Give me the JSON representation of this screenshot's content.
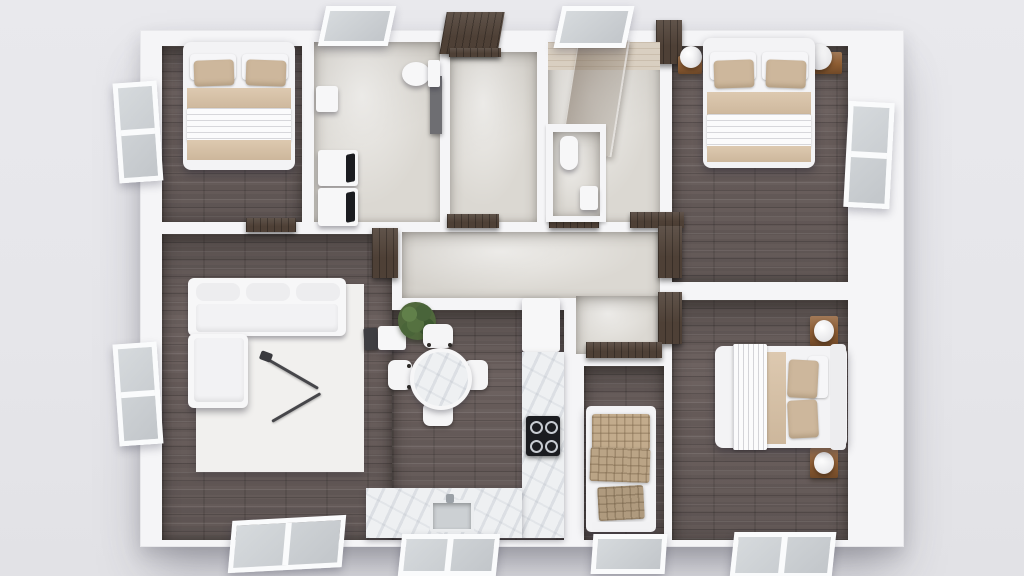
{
  "scene": {
    "description": "Top-down 3D architectural rendering of a three-bedroom apartment floor plan; photorealistic render with no text labels",
    "rooms": [
      {
        "id": "bedroom-1",
        "position": "top-left",
        "flooring": "dark wood planks",
        "furniture": [
          "double bed with white duvet and two beige pillows"
        ]
      },
      {
        "id": "bathroom-laundry",
        "position": "top-center-left",
        "flooring": "light concrete",
        "furniture": [
          "toilet",
          "white wall cabinet",
          "stacked washer and dryer",
          "dark vanity strip"
        ]
      },
      {
        "id": "entry-hall",
        "position": "top-center",
        "flooring": "light concrete",
        "furniture": [
          "open dark-walnut front door"
        ]
      },
      {
        "id": "bathroom-2",
        "position": "top-center-right",
        "flooring": "light concrete with travertine band",
        "furniture": [
          "smoked-glass shower screen",
          "WC niche with toilet",
          "small white cabinet"
        ]
      },
      {
        "id": "bedroom-2",
        "position": "top-right",
        "flooring": "dark wood planks",
        "furniture": [
          "double bed with white duvet and beige pillows",
          "two nightstands",
          "two white sphere lamps"
        ]
      },
      {
        "id": "living-room",
        "position": "center-left",
        "flooring": "dark wood planks",
        "furniture": [
          "white L-shaped sectional sofa",
          "white area rug",
          "black angled floor lamp",
          "white side table",
          "potted plant",
          "small dark speaker"
        ]
      },
      {
        "id": "dining-area",
        "position": "center",
        "flooring": "dark wood planks",
        "furniture": [
          "round marble dining table",
          "four white chairs with dark arm tips"
        ]
      },
      {
        "id": "kitchen",
        "position": "center-right",
        "flooring": "dark wood planks",
        "furniture": [
          "L-shaped marble counter",
          "black four-burner cooktop",
          "inset sink with faucet",
          "tall white cabinet-fridge"
        ]
      },
      {
        "id": "hallway",
        "position": "center",
        "flooring": "light concrete",
        "furniture": []
      },
      {
        "id": "kids-bedroom",
        "position": "bottom-center",
        "flooring": "dark wood planks",
        "furniture": [
          "single bed with beige checkered bedding and pillow"
        ]
      },
      {
        "id": "bedroom-3",
        "position": "bottom-right",
        "flooring": "dark wood planks",
        "furniture": [
          "double bed with white throw, beige runner and beige pillows",
          "two wooden nightstands with white lamps"
        ]
      }
    ],
    "openings": {
      "doors": [
        "front door (top center, shown open)",
        "bedroom-1 door",
        "living-room door",
        "entry-to-hall door",
        "bathroom-2 door",
        "bedroom-2 door",
        "bedroom-3 door",
        "kids-bedroom door",
        "hall wardrobe"
      ],
      "windows": [
        "left wall: 2 open casements",
        "right wall: 1 open casement",
        "top wall: 2 tilted awning windows",
        "bottom wall: 4 laid-open windows"
      ]
    }
  },
  "palette": {
    "bg": "#e9e9ed",
    "wall": "#f5f5f7",
    "wood": "#6d6260",
    "concrete": "#dbd8d2",
    "marble": "#eef0f2",
    "walnut": "#4e4036",
    "beige": "#cdb79c",
    "beige-dark": "#c2ab8c",
    "white-furniture": "#f7f7f8",
    "nightstand": "#8d5c32",
    "foliage": "#50683c",
    "appliance": "#1b1c20",
    "glass": "#8a7a68"
  }
}
